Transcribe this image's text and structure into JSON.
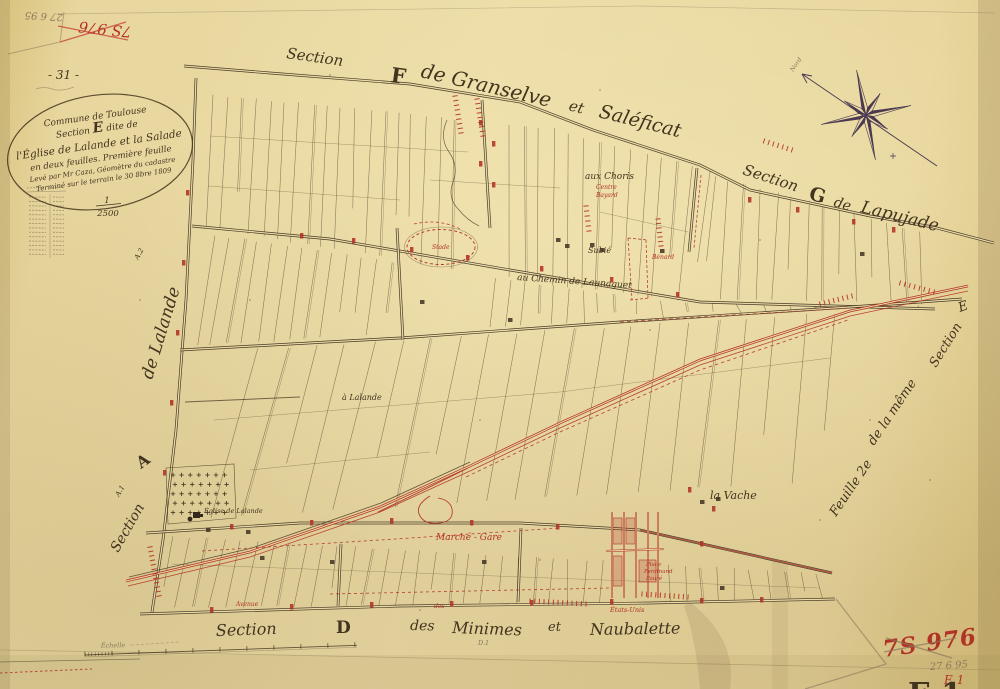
{
  "corner_top_left": {
    "pencil_note": "27 6 95",
    "red_ref": "7S 976",
    "page_number": "- 31 -"
  },
  "cartouche": {
    "line1": "Commune de Toulouse",
    "line2_pre": "Section",
    "line2_letter": "E",
    "line2_post": "dite de",
    "line3": "l'Église de Lalande et la Salade",
    "line4": "en deux feuilles. Première feuille",
    "line5": "Levé par Mr Caza, Géomètre du cadastre",
    "line6": "Terminé sur le terrain le 30 8bre 1809"
  },
  "margin": {
    "scale_numerator": "1",
    "scale_denominator": "2500",
    "scale_bar_label": "Échelle"
  },
  "sections": {
    "top": {
      "section_word": "Section",
      "letter": "F",
      "name_part1": "de Granselve",
      "et": "et",
      "name_part2": "Saléficat"
    },
    "right": {
      "section_word": "Section",
      "letter": "G",
      "de": "de",
      "name": "Lapujade"
    },
    "bottom": {
      "section_word": "Section",
      "letter": "D",
      "des": "des",
      "name_part1": "Minimes",
      "et": "et",
      "name_part2": "Naubalette",
      "pencil_sub": "D.1"
    },
    "left": {
      "de_name": "de Lalande",
      "letter": "A",
      "section_word": "Section",
      "sub_top": "A.2",
      "sub_bottom": "A.1"
    },
    "right_edge": {
      "part1": "Feuille 2e",
      "part2": "de la même",
      "part3": "Section",
      "letter": "E"
    }
  },
  "places": {
    "aux_choris": "aux Choris",
    "subie": "Subié",
    "launaguet": "au Chemin de Launaguet",
    "a_lalande": "à Lalande",
    "la_vache": "la Vache",
    "eglise": "Église de Lalande"
  },
  "red_labels": {
    "centre": "Centre",
    "bayard": "Bayard",
    "benard": "Bénard",
    "stade": "Stade",
    "marche_gare": "Marché - Gare",
    "avenue": "Avenue",
    "des": "des",
    "etats_unis": "États-Unis",
    "place_l1": "Place",
    "place_l2": "Ferdinand",
    "place_l3": "Fauré"
  },
  "compass": {
    "north_label": "Nord"
  },
  "corner_bottom_right": {
    "red_ref": "7S 976",
    "pencil_date": "27 6 95",
    "red_sheet": "E 1",
    "big_letter": "E 1"
  }
}
